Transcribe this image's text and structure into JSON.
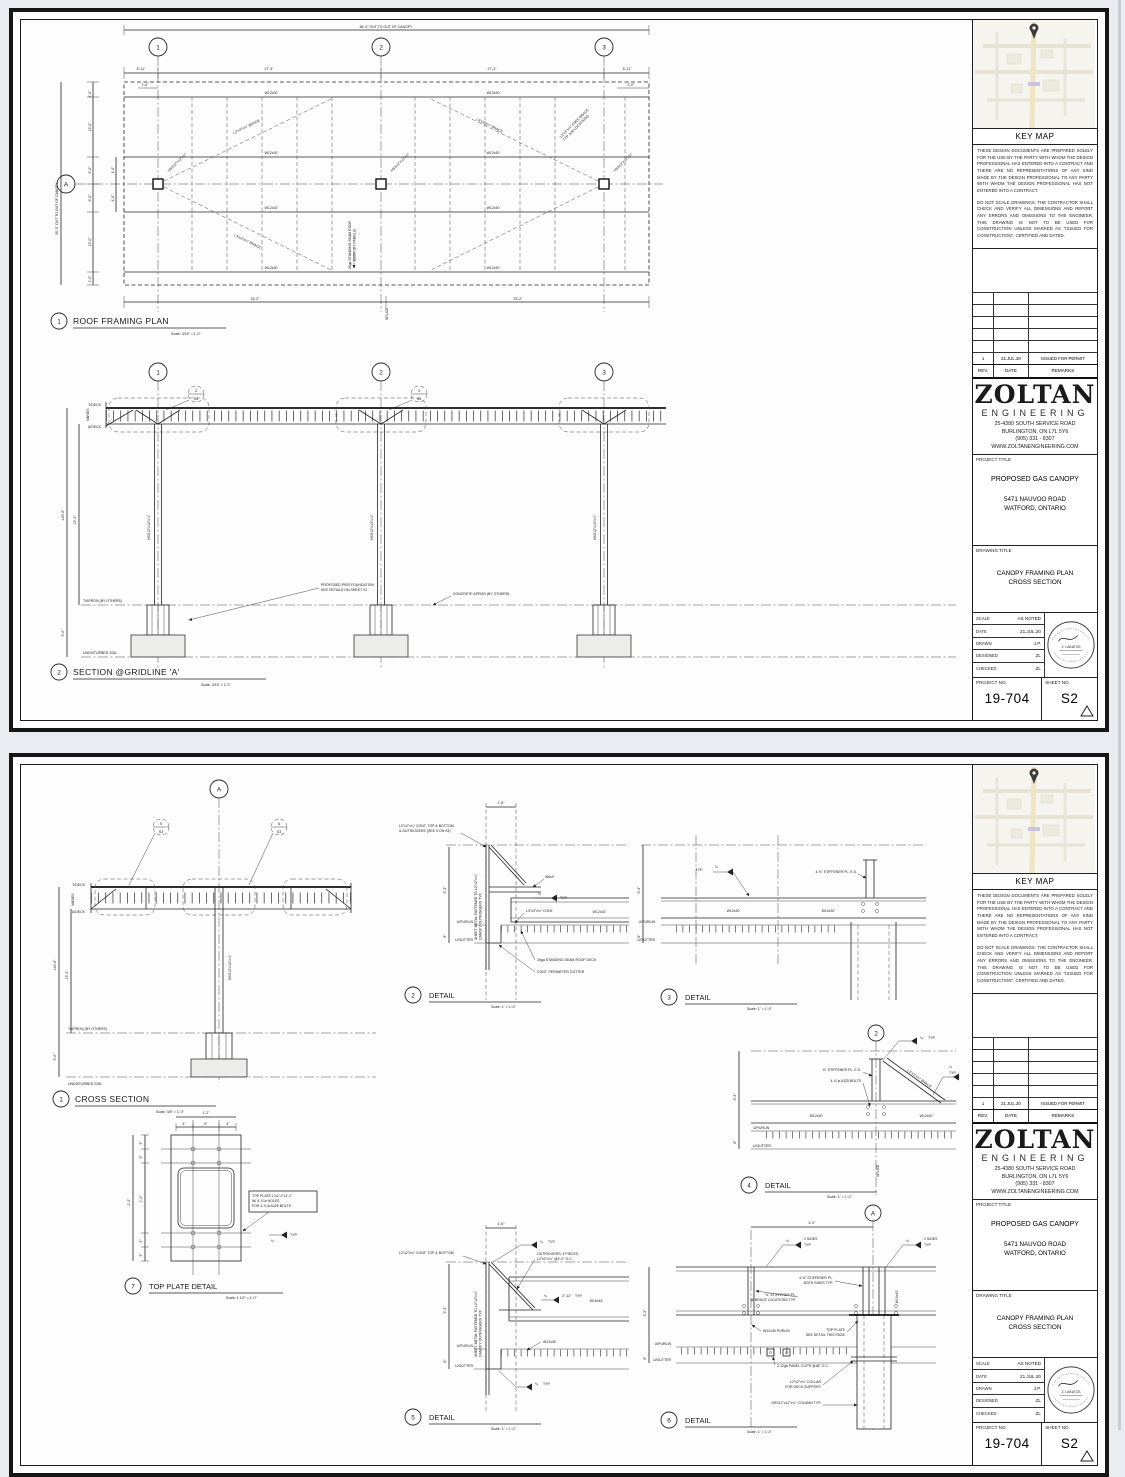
{
  "c": {
    "beam": "W12x30",
    "girder": "W16x45",
    "purlin_beam": "W12x30 PURLIN",
    "col": "HSS12\"x12\"x¼\"",
    "brace": "L3\"x3\"x¼\" BRACE",
    "detail": "DETAIL",
    "g1": "1",
    "g2": "2",
    "g3": "3",
    "grid_a": "A",
    "t_deck": "T/DECK",
    "u_deck": "U/DECK",
    "varies": "VARIES",
    "t_apron": "T/APRON (BY OTHERS)",
    "soil": "UNDISTURBED SOIL",
    "u_purlin": "U/PURLIN",
    "u_gutter": "U/GUTTER",
    "dim_3_3": "3'-3\"",
    "dim_8": "8\"",
    "dim_1_6": "1'-6\"",
    "dim_16_6": "±16'-6\"",
    "dim_13_4": "13'-4\"",
    "dim_5_0": "5'-0\"",
    "weld_quarter": "¼",
    "typ": "TYP.",
    "two_sides": "2 SIDES",
    "ref_s3": "S3",
    "scale_316": "Scale: 3/16\" = 1'-0\"",
    "scale_38": "Scale: 3/8\" = 1'-0\"",
    "scale_1": "Scale: 1\" = 1'-0\"",
    "scale_112": "Scale: 1 1/2\" = 1'-0\""
  },
  "p1": {
    "plan": {
      "num": "1",
      "title": "ROOF FRAMING PLAN",
      "dim_top": "66'-4\" OUT TO OUT OF CANOPY",
      "dim_left": "30'-0\" OUT TO OUT OF CANOPY",
      "d_end": "5'-11\"",
      "d_bay": "27'-3\"",
      "d_1_0": "1'-0\"",
      "d_2_0": "2'-0\"",
      "d_13": "13'-0\"",
      "d_6": "6'-0\"",
      "d_4": "4'-0\"",
      "d_33_2": "33'-2\"",
      "splice": "SPLICE",
      "deck_note_1": "26ga STANDING SEAM ROOF",
      "deck_note_2": "DECK (BY PANELS)",
      "knee_1": "L3\"x3\"x¼\" KNEE BRACE",
      "knee_2": "TYP. (x8) LOCATIONS"
    },
    "section": {
      "num": "2",
      "title": "SECTION @GRIDLINE 'A'",
      "found_1": "PROPOSED PIER FOUNDATION",
      "found_2": "SEE DETAILS ON SHEET S1",
      "apron_note": "CONCRETE APRON (BY OTHERS)",
      "ref_a": "2",
      "ref_b": "3"
    }
  },
  "p2": {
    "xsec": {
      "num": "1",
      "title": "CROSS SECTION",
      "ref_a": "5",
      "ref_b": "6"
    },
    "d2": {
      "num": "2",
      "cont_1": "L2\"x2\"x¼\" CONT. TOP & BOTTOM",
      "cont_2": "& OUTRIGGERS (SEE 5 ON S3)",
      "w6": "W6x9",
      "l3_cont": "L3\"x3\"x¼\" CONT.",
      "sheet_1": "SHEET METAL FASTENED TO L2\"x2\"x¼\"",
      "sheet_2": "CANOPY OUTRIGGERS TYP.",
      "deck_note": "26ga STANDING SEAM ROOF DECK",
      "gutter_note": "CONT. PERIMETER GUTTER"
    },
    "d3": {
      "num": "3",
      "stiff": "4-⅜\" STIFFENER PL. E.S."
    },
    "d4": {
      "num": "4",
      "stiff": "⅜\" STIFFENER PL. E.S.",
      "bolts": "4-¾\"ø A325 BOLTS",
      "splice": "SPLICE"
    },
    "d5": {
      "num": "5",
      "cont": "L2\"x2\"x¼\" CONT. TOP & BOTTOM",
      "out_1": "OUTRIGGERS: 4 PIECES",
      "out_2": "L2\"x2\"x¼\" @4'-0\" O.C.",
      "stitch": "2\"-12\"",
      "sheet_1": "SHEET METAL FASTENED TO L2\"x2\"x¼\"",
      "sheet_2": "CANOPY OUTRIGGERS TYP."
    },
    "d6": {
      "num": "6",
      "dim_4_0": "4'-0\"",
      "stiff4_1": "4-⅜\" STIFFENER PL.",
      "stiff4_2": "BOTH SIDES TYP.",
      "stiff_1": "⅜\" STIFFENER PL.",
      "stiff_2": "@ BRACE LOCATIONS TYP.",
      "top_plate_1": "TOP PLATE",
      "top_plate_2": "SEE DETAIL THIS PAGE",
      "clips": "2-12ga PANEL CLIPS @48\" O.C.",
      "collar_1": "L2\"x2\"x¼\" COLLAR",
      "collar_2": "FOR DECK SUPPORT",
      "col_note": "HSS12\"x12\"x¼\" COLUMN TYP."
    },
    "d7": {
      "num": "7",
      "title": "TOP PLATE DETAIL",
      "dim_1_2": "1'-2\"",
      "dim_4": "4\"",
      "dim_6": "6\"",
      "dim_2_2": "2'-2\"",
      "dim_3": "3\"",
      "dim_1_4": "1'-4\"",
      "note_1": "TOP PLATE 1\"x2'-2\"x1'-2\"",
      "note_2": "W/ 4-⅞\"ø HOLES",
      "note_3": "FOR 4-¾\"ø A325 BOLTS"
    }
  },
  "titleblock": {
    "key_map": "KEY MAP",
    "disclaimer_1": "THESE DESIGN DOCUMENTS ARE PREPARED SOLELY FOR THE USE BY THE PARTY WITH WHOM THE DESIGN PROFESSIONAL HAS ENTERED INTO A CONTRACT AND THERE ARE NO REPRESENTATIONS OF ANY KIND MADE BY THE DESIGN PROFESSIONAL TO ANY PARTY WITH WHOM THE DESIGN PROFESSIONAL HAS NOT ENTERED INTO A CONTRACT.",
    "disclaimer_2": "DO NOT SCALE DRAWINGS. THE CONTRACTOR SHALL CHECK AND VERIFY ALL DIMENSIONS AND REPORT ANY ERRORS AND OMISSIONS TO THE ENGINEER. THIS DRAWING IS NOT TO BE USED FOR CONSTRUCTION UNLESS MARKED AS \"ISSUED FOR CONSTRUCTION\", CERTIFIED AND DATED.",
    "rev_no": "1",
    "rev_date": "21.JUL.20",
    "rev_remarks": "ISSUED FOR PERMIT",
    "rev_h": "REV.",
    "date_h": "DATE",
    "remarks_h": "REMARKS",
    "brand": "ZOLTAN",
    "brand2": "ENGINEERING",
    "addr1": "25-4380 SOUTH SERVICE ROAD",
    "addr2": "BURLINGTON, ON L7L 5Y6",
    "addr3": "(905) 331 - 8307",
    "addr4": "WWW.ZOLTANENGINEERING.COM",
    "project_label": "PROJECT TITLE",
    "project": "PROPOSED GAS CANOPY",
    "proj_addr1": "5471 NAUVOO ROAD",
    "proj_addr2": "WATFORD, ONTARIO",
    "drawing_label": "DRAWING TITLE",
    "drawing1": "CANOPY FRAMING PLAN",
    "drawing2": "CROSS SECTION",
    "scale_l": "SCALE",
    "scale_v": "AS NOTED",
    "date_l": "DATE",
    "date_v": "21.JUL.20",
    "drawn_l": "DRAWN",
    "drawn_v": "J.P.",
    "designed_l": "DESIGNED",
    "designed_v": "ZL",
    "checked_l": "CHECKED",
    "checked_v": "ZL",
    "projno_l": "PROJECT NO.",
    "projno_v": "19-704",
    "sheet_l": "SHEET NO.",
    "sheet_v": "S2",
    "stamp_name": "Z. LAKATOS"
  }
}
